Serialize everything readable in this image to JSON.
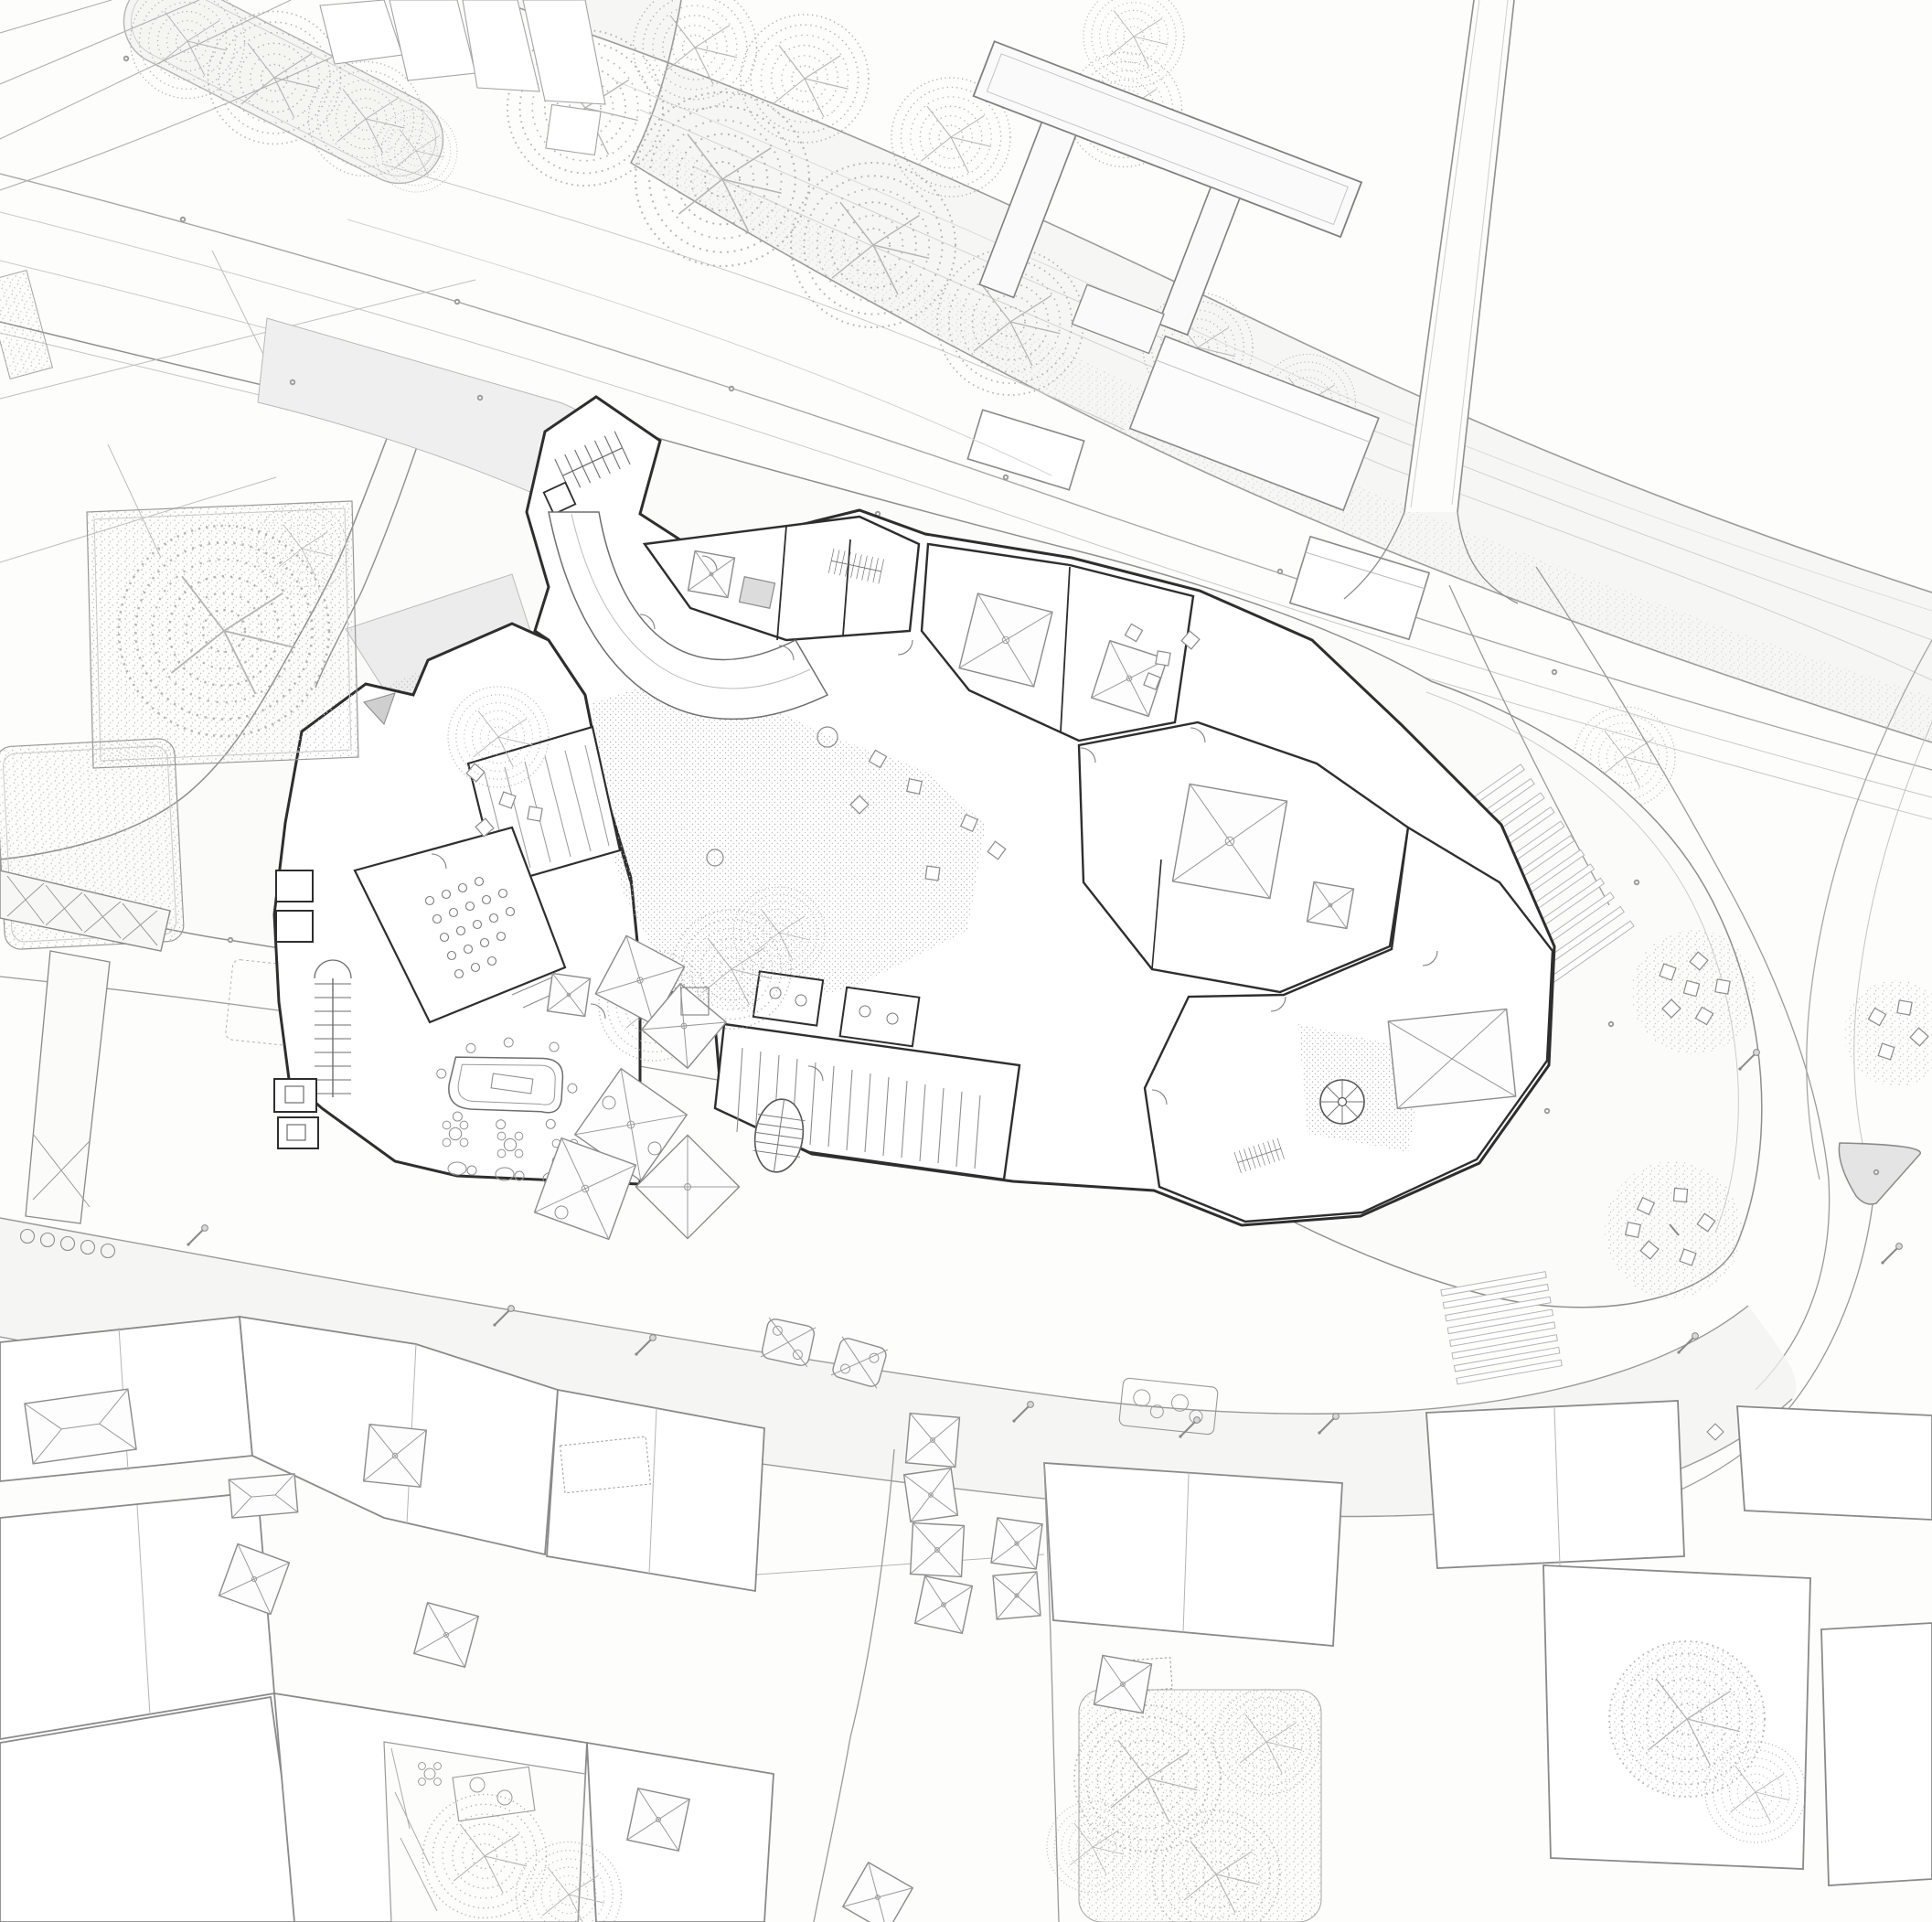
{
  "scene": {
    "kind": "architectural-site-plan",
    "description": "Black and white architectural site plan: ground floor of a museum block beside a river avenue, surrounded by plazas, streets and old-town rooftops"
  },
  "palette": {
    "paper": "#fdfdfc",
    "wall_line": "#2e2e2e",
    "mid_line": "#9a9a9a",
    "light_line": "#c9c9c9",
    "detail_line": "#6e6e6e",
    "road_fill": "#f1f1f2",
    "plaza_fill": "#fbfbfa",
    "median_fill": "#f5f5f2",
    "river_fill": "#f6f6f5",
    "island_fill": "#e4e4e4",
    "entry_paving_fill": "#ececec",
    "stipple_dot": "#adadad",
    "tree_stroke": "#a9a9a9"
  },
  "features": [
    {
      "id": "river",
      "label": "river with bank contour lines"
    },
    {
      "id": "bridge",
      "label": "bridge crossing river"
    },
    {
      "id": "pier-platform",
      "label": "T-shaped pier structure over river"
    },
    {
      "id": "avenue",
      "label": "diagonal avenue with lane lines"
    },
    {
      "id": "tree-median",
      "label": "pill-shaped tree-planted median"
    },
    {
      "id": "greenway-trees",
      "label": "riverside tree canopies"
    },
    {
      "id": "museum-building",
      "label": "detailed ground-floor building complex"
    },
    {
      "id": "north-stair-tip",
      "label": "north stair tip block"
    },
    {
      "id": "curved-ramp",
      "label": "curved ramp band"
    },
    {
      "id": "courtyard-paving",
      "label": "stippled courtyard paving"
    },
    {
      "id": "auditorium-seating",
      "label": "auditorium seat rows"
    },
    {
      "id": "cafe-furniture",
      "label": "bar counter and cafe tables"
    },
    {
      "id": "pyramid-skylights",
      "label": "pyramidal skylights with X diagonals"
    },
    {
      "id": "spiral-stair",
      "label": "spiral stair"
    },
    {
      "id": "straight-stairs",
      "label": "straight stair runs",
      "count": 6
    },
    {
      "id": "plaza-teardrop",
      "label": "teardrop shaped plaza"
    },
    {
      "id": "seating-circles",
      "label": "stippled circles with benches",
      "count": 3
    },
    {
      "id": "traffic-islands",
      "label": "gray traffic islands",
      "count": 2
    },
    {
      "id": "crosswalks",
      "label": "zebra crosswalks",
      "count": 2
    },
    {
      "id": "street-lamps",
      "label": "street lamps"
    },
    {
      "id": "bollards",
      "label": "bollard dots along curbs"
    },
    {
      "id": "street-planters",
      "label": "street planters with X pattern"
    },
    {
      "id": "pergola",
      "label": "X-braced pergola walk"
    },
    {
      "id": "garden-plots",
      "label": "stippled garden plots with trees"
    },
    {
      "id": "old-town-blocks",
      "label": "old town roof plans"
    },
    {
      "id": "hip-roofs",
      "label": "hipped roofs with ridge diagonals"
    },
    {
      "id": "courtyard-gardens",
      "label": "courtyard gardens with trees and tables"
    },
    {
      "id": "alley",
      "label": "narrow descending street"
    }
  ]
}
